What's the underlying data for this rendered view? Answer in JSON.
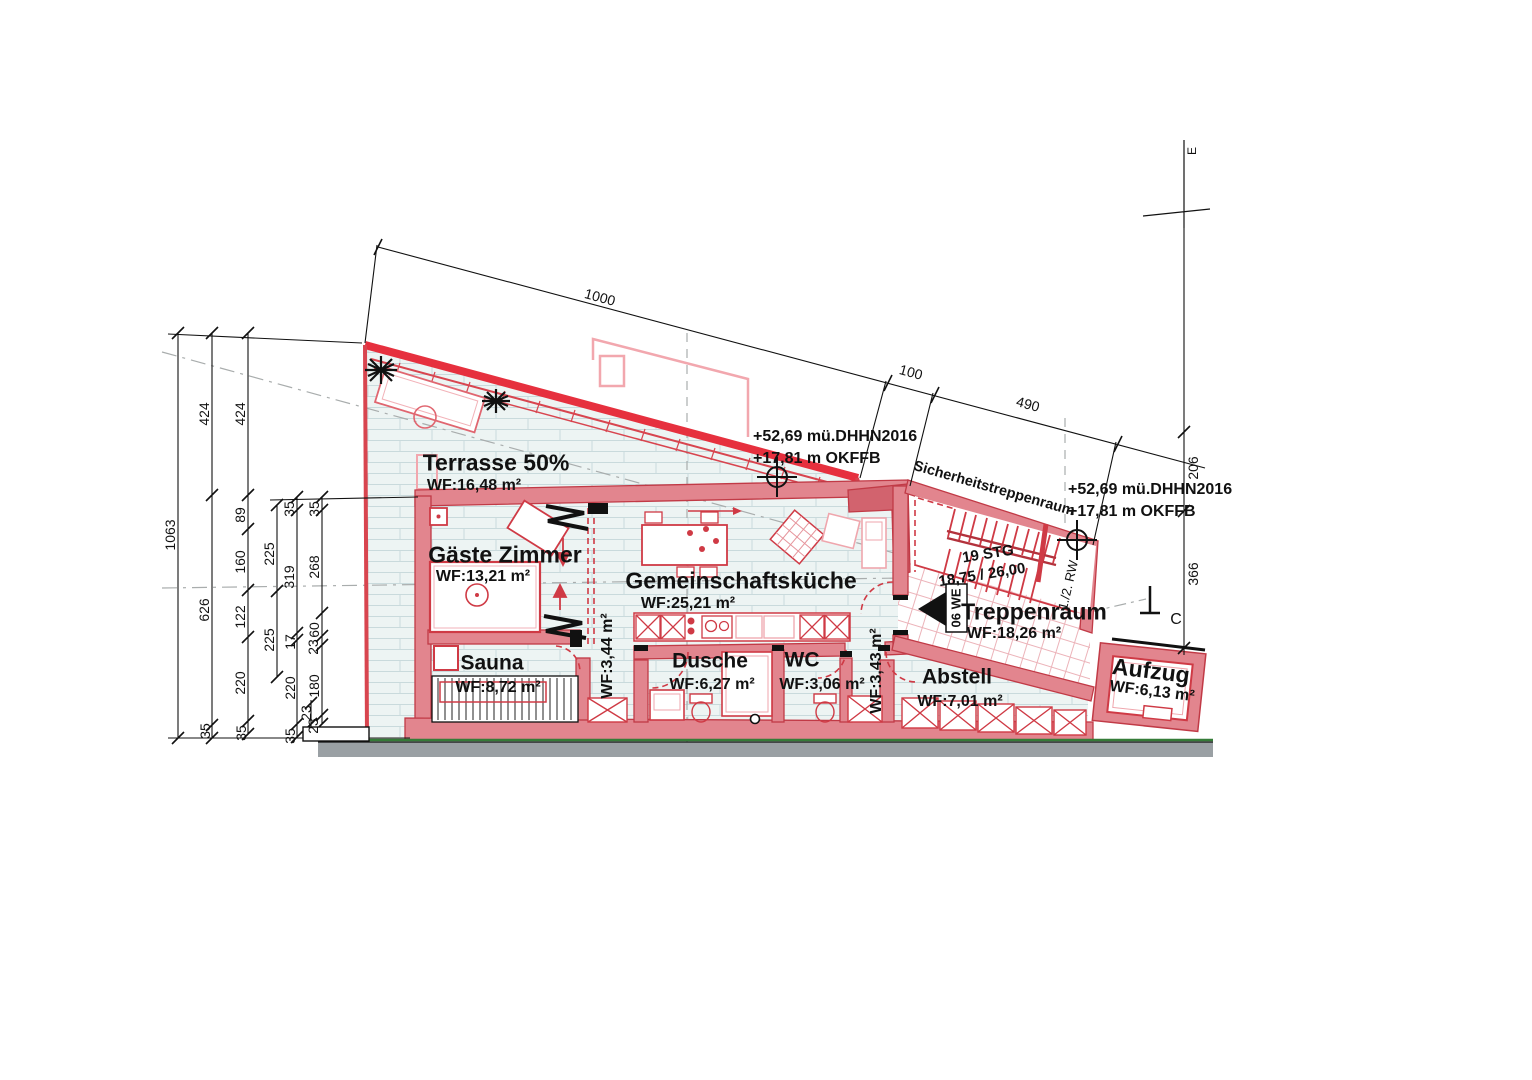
{
  "drawing": {
    "type": "floor-plan",
    "colors": {
      "wall_fill": "#e2858e",
      "wall_edge": "#c13a46",
      "roof_red": "#e6303e",
      "fixture_red": "#cf3a45",
      "pale_pink": "#efa6ad",
      "floor_tint": "#edf4f3",
      "plank_line": "#c9dadc",
      "ground_green": "#357c38",
      "terrain_gray": "#9aa0a4"
    }
  },
  "rooms": {
    "terrasse": {
      "name": "Terrasse 50%",
      "area": "WF:16,48 m²"
    },
    "gaeste": {
      "name": "Gäste Zimmer",
      "area": "WF:13,21 m²"
    },
    "kueche": {
      "name": "Gemeinschaftsküche",
      "area": "WF:25,21 m²"
    },
    "sauna": {
      "name": "Sauna",
      "area": "WF:8,72 m²"
    },
    "flur1": {
      "area": "WF:3,44 m²"
    },
    "dusche": {
      "name": "Dusche",
      "area": "WF:6,27 m²"
    },
    "wc": {
      "name": "WC",
      "area": "WF:3,06 m²"
    },
    "flur2": {
      "area": "WF:3,43 m²"
    },
    "abstell": {
      "name": "Abstell",
      "area": "WF:7,01 m²"
    },
    "treppenraum": {
      "name": "Treppenraum",
      "area": "WF:18,26 m²"
    },
    "aufzug": {
      "name": "Aufzug",
      "area": "WF:6,13 m²"
    },
    "sicherheit": {
      "name": "Sicherheitstreppenraum"
    }
  },
  "annotations": {
    "elevation1": "+52,69 mü.DHHN2016",
    "elevation2": "+17,81 m OKFFB",
    "stairs_count": "19 STG",
    "stairs_dims": "18,75 / 26,00",
    "unit": "06 WE",
    "rw": "1./2. RW",
    "section": "C",
    "axis": "E"
  },
  "dim_left": [
    "1063",
    "424",
    "626",
    "35",
    "424",
    "89",
    "160",
    "122",
    "220",
    "35",
    "225",
    "225",
    "35",
    "319",
    "17",
    "220",
    "35",
    "35",
    "268",
    "60",
    "23",
    "180",
    "23",
    "23"
  ],
  "dim_top": [
    "1000",
    "100",
    "490"
  ],
  "dim_right": [
    "206",
    "366"
  ]
}
